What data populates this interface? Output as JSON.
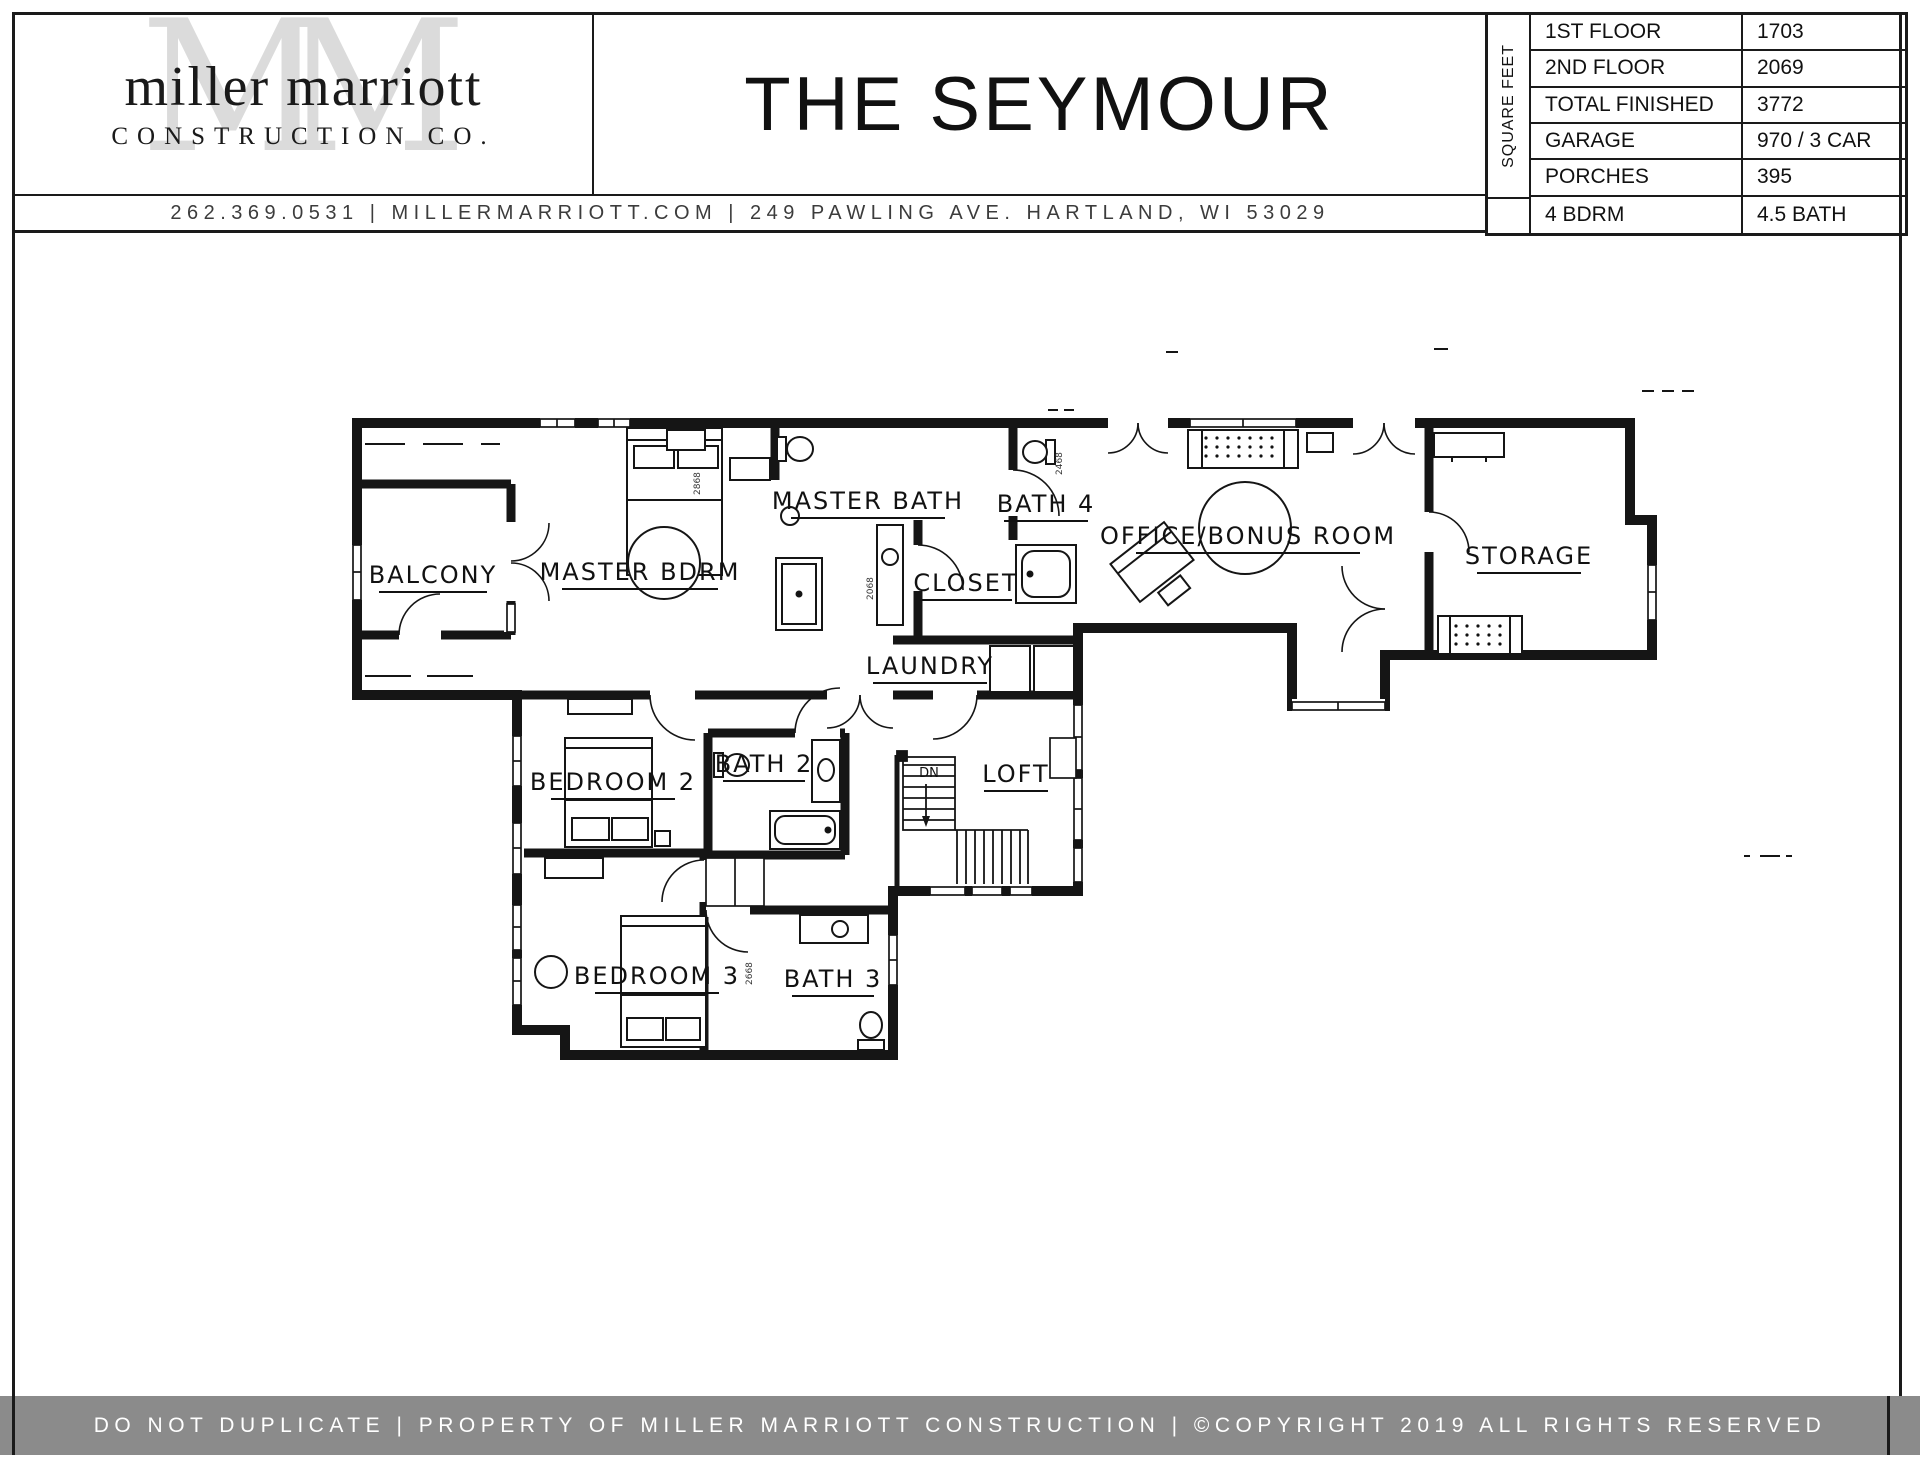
{
  "header": {
    "logo": {
      "monogram": "MM",
      "name_line": "miller marriott",
      "sub_line": "CONSTRUCTION CO."
    },
    "title": "THE SEYMOUR",
    "contact": "262.369.0531  |  MILLERMARRIOTT.COM   |   249 PAWLING AVE. HARTLAND, WI 53029"
  },
  "spec_table": {
    "side_label": "SQUARE FEET",
    "rows": [
      {
        "label": "1ST FLOOR",
        "value": "1703"
      },
      {
        "label": "2ND FLOOR",
        "value": "2069"
      },
      {
        "label": "TOTAL FINISHED",
        "value": "3772"
      },
      {
        "label": "GARAGE",
        "value": "970 / 3 CAR"
      },
      {
        "label": "PORCHES",
        "value": "395"
      },
      {
        "label": "4 BDRM",
        "value": "4.5 BATH"
      }
    ]
  },
  "floor_plan": {
    "rooms": [
      {
        "label": "BALCONY"
      },
      {
        "label": "MASTER BDRM"
      },
      {
        "label": "MASTER BATH"
      },
      {
        "label": "BATH 4"
      },
      {
        "label": "CLOSET"
      },
      {
        "label": "LAUNDRY"
      },
      {
        "label": "OFFICE/BONUS ROOM"
      },
      {
        "label": "STORAGE"
      },
      {
        "label": "BEDROOM 2"
      },
      {
        "label": "BATH 2"
      },
      {
        "label": "LOFT"
      },
      {
        "label": "BEDROOM 3"
      },
      {
        "label": "BATH 3"
      }
    ],
    "stairs_label": "DN",
    "dimension_notes": [
      "2868",
      "2068",
      "2468",
      "2668"
    ]
  },
  "footer": {
    "text": "DO NOT DUPLICATE | PROPERTY OF MILLER MARRIOTT CONSTRUCTION | ©COPYRIGHT 2019 ALL RIGHTS RESERVED",
    "background": "#8b8b8b"
  }
}
